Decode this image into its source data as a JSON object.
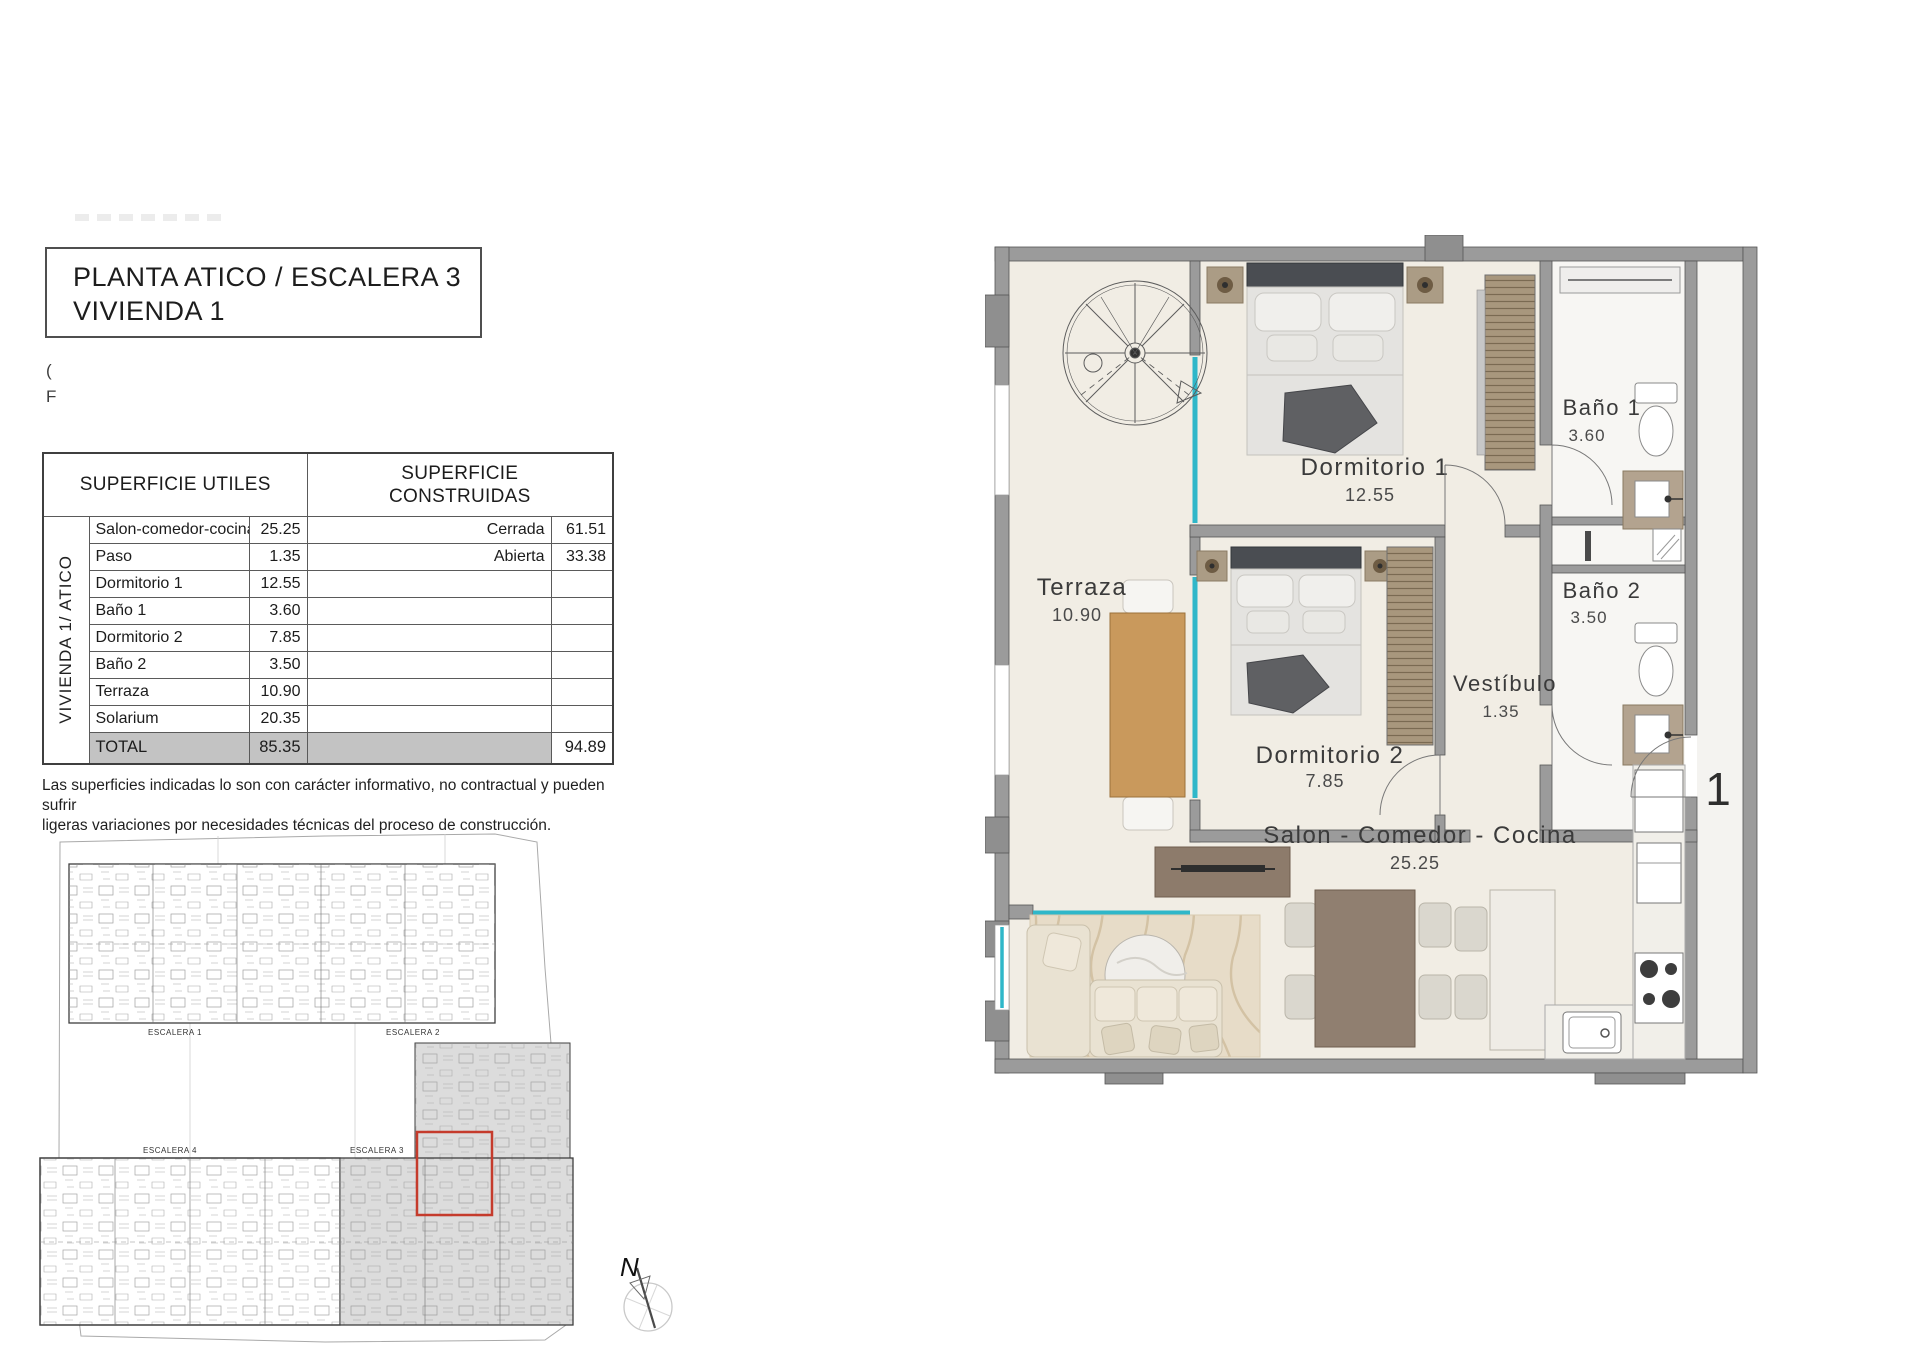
{
  "title_block": {
    "line1": "PLANTA ATICO / ESCALERA 3",
    "line2": "VIVIENDA 1"
  },
  "stray_text": {
    "char1": "(",
    "char2": "F"
  },
  "areas_table": {
    "col_utiles": "SUPERFICIE UTILES",
    "col_construidas": "SUPERFICIE CONSTRUIDAS",
    "group_label": "VIVIENDA 1/ ATICO",
    "rows": [
      {
        "name": "Salon-comedor-cocina",
        "util": "25.25",
        "cons_name": "Cerrada",
        "cons_val": "61.51"
      },
      {
        "name": "Paso",
        "util": "1.35",
        "cons_name": "Abierta",
        "cons_val": "33.38"
      },
      {
        "name": "Dormitorio 1",
        "util": "12.55",
        "cons_name": "",
        "cons_val": ""
      },
      {
        "name": "Baño 1",
        "util": "3.60",
        "cons_name": "",
        "cons_val": ""
      },
      {
        "name": "Dormitorio 2",
        "util": "7.85",
        "cons_name": "",
        "cons_val": ""
      },
      {
        "name": "Baño 2",
        "util": "3.50",
        "cons_name": "",
        "cons_val": ""
      },
      {
        "name": "Terraza",
        "util": "10.90",
        "cons_name": "",
        "cons_val": ""
      },
      {
        "name": "Solarium",
        "util": "20.35",
        "cons_name": "",
        "cons_val": ""
      }
    ],
    "total_label": "TOTAL",
    "total_util": "85.35",
    "total_cons": "94.89"
  },
  "disclaimer_line1": "Las superficies indicadas lo son con carácter informativo, no contractual y pueden sufrir",
  "disclaimer_line2": "ligeras variaciones por necesidades técnicas del proceso de construcción.",
  "key_plan": {
    "escalera_1": "ESCALERA 1",
    "escalera_2": "ESCALERA 2",
    "escalera_3": "ESCALERA 3",
    "escalera_4": "ESCALERA 4",
    "north": "N",
    "highlight_color": "#c53b2c"
  },
  "floor_plan": {
    "unit_number": "1",
    "rooms": {
      "terraza": {
        "name": "Terraza",
        "area": "10.90"
      },
      "dormitorio1": {
        "name": "Dormitorio 1",
        "area": "12.55"
      },
      "dormitorio2": {
        "name": "Dormitorio 2",
        "area": "7.85"
      },
      "bano1": {
        "name": "Baño 1",
        "area": "3.60"
      },
      "bano2": {
        "name": "Baño 2",
        "area": "3.50"
      },
      "vestibulo": {
        "name": "Vestíbulo",
        "area": "1.35"
      },
      "salon": {
        "name": "Salon - Comedor - Cocina",
        "area": "25.25"
      }
    },
    "colors": {
      "wall": "#9b9b9b",
      "glass": "#2fb7c9",
      "floor": "#f1ede4",
      "wood": "#c9995c"
    }
  }
}
